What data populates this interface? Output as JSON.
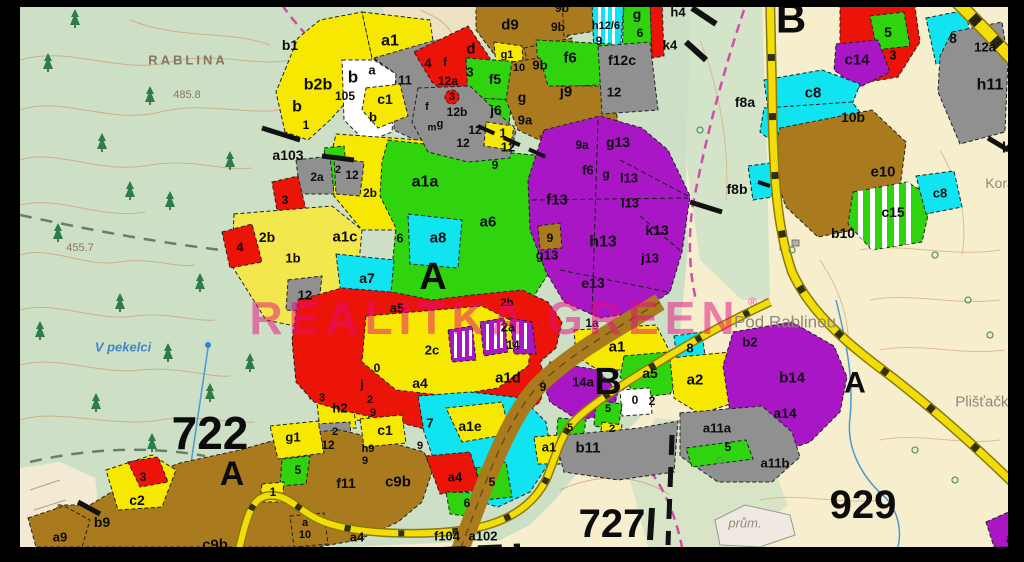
{
  "map": {
    "watermark": {
      "text": "REALITKA GREEN",
      "reg": "®",
      "color": "#e60b84"
    },
    "palette": {
      "yellow": "#f6e800",
      "green": "#2fd40e",
      "cyan": "#10e4f0",
      "red": "#ec1309",
      "purple": "#a816c6",
      "brown": "#a97b1e",
      "gray": "#909090",
      "white": "#ffffff",
      "topo_green": "#cde0c6",
      "topo_cream": "#f6eecd",
      "road_yellow": "#f2dd07",
      "frame": "#000000",
      "water": "#4a9ad4",
      "contour": "#cf9d72"
    },
    "place_names": [
      {
        "t": "RABLINA",
        "x": 188,
        "y": 60,
        "s": 13,
        "c": "#8a7560",
        "sp": 3,
        "w": "bold"
      },
      {
        "t": "V pekelci",
        "x": 123,
        "y": 347,
        "s": 13,
        "c": "#3f86c8",
        "i": true,
        "w": "bold"
      },
      {
        "t": "Pod Rablinou",
        "x": 785,
        "y": 322,
        "s": 17,
        "c": "#8f887a",
        "w": "normal"
      },
      {
        "t": "Plišťačka",
        "x": 986,
        "y": 402,
        "s": 15,
        "c": "#8f887a",
        "w": "normal"
      },
      {
        "t": "Korá",
        "x": 1000,
        "y": 183,
        "s": 14,
        "c": "#8f887a",
        "w": "normal"
      },
      {
        "t": "prům.",
        "x": 745,
        "y": 523,
        "s": 13,
        "c": "#8f887a",
        "i": true,
        "w": "normal"
      }
    ],
    "elevation_points": [
      {
        "t": "485.8",
        "x": 187,
        "y": 95,
        "s": 11,
        "c": "#8a7560"
      },
      {
        "t": "455.7",
        "x": 80,
        "y": 248,
        "s": 11,
        "c": "#8a7560"
      }
    ],
    "zone_labels": [
      [
        "722",
        210,
        433,
        46
      ],
      [
        "A",
        232,
        474,
        34
      ],
      [
        "727",
        612,
        524,
        40
      ],
      [
        "929",
        863,
        505,
        40
      ],
      [
        "A",
        433,
        277,
        38
      ],
      [
        "B",
        791,
        18,
        42
      ],
      [
        "B",
        608,
        382,
        38
      ],
      [
        "A",
        855,
        383,
        30
      ]
    ],
    "parcel_labels": [
      [
        "b1",
        290,
        45,
        14
      ],
      [
        "b2b",
        318,
        85,
        16
      ],
      [
        "b",
        297,
        107,
        16
      ],
      [
        "1",
        306,
        125,
        12
      ],
      [
        "b",
        353,
        77,
        17
      ],
      [
        "105",
        345,
        96,
        12
      ],
      [
        "a",
        372,
        70,
        13
      ],
      [
        "11",
        405,
        80,
        13
      ],
      [
        "c1",
        385,
        99,
        14
      ],
      [
        "b",
        373,
        117,
        13
      ],
      [
        "a1",
        390,
        41,
        16
      ],
      [
        "d9",
        510,
        25,
        15
      ],
      [
        "9b",
        562,
        8,
        12
      ],
      [
        "9b",
        558,
        27,
        12
      ],
      [
        "h12/6",
        606,
        26,
        11
      ],
      [
        "9",
        599,
        41,
        12
      ],
      [
        "g",
        637,
        14,
        14
      ],
      [
        "6",
        640,
        33,
        12
      ],
      [
        "4",
        428,
        63,
        13
      ],
      [
        "d",
        471,
        49,
        15
      ],
      [
        "3",
        470,
        72,
        13
      ],
      [
        "f",
        445,
        62,
        12
      ],
      [
        "12a",
        448,
        81,
        12
      ],
      [
        "3",
        452,
        97,
        11
      ],
      [
        "f5",
        495,
        79,
        14
      ],
      [
        "g1",
        507,
        55,
        11
      ],
      [
        "10",
        519,
        68,
        11
      ],
      [
        "9b",
        540,
        65,
        13
      ],
      [
        "f6",
        570,
        58,
        15
      ],
      [
        "f12c",
        622,
        60,
        14
      ],
      [
        "12",
        614,
        92,
        13
      ],
      [
        "g",
        522,
        97,
        14
      ],
      [
        "j9",
        566,
        92,
        15
      ],
      [
        "j6",
        496,
        110,
        14
      ],
      [
        "9a",
        525,
        120,
        13
      ],
      [
        "1",
        503,
        133,
        13
      ],
      [
        "12",
        508,
        147,
        13
      ],
      [
        "12",
        475,
        130,
        12
      ],
      [
        "12",
        463,
        143,
        12
      ],
      [
        "12b",
        457,
        112,
        12
      ],
      [
        "f",
        427,
        107,
        11
      ],
      [
        "g",
        440,
        124,
        11
      ],
      [
        "m",
        432,
        128,
        10
      ],
      [
        "9a",
        582,
        145,
        12
      ],
      [
        "f6",
        588,
        170,
        13
      ],
      [
        "g",
        606,
        174,
        12
      ],
      [
        "9",
        495,
        165,
        12
      ],
      [
        "g13",
        618,
        142,
        14
      ],
      [
        "l13",
        629,
        178,
        13
      ],
      [
        "l13",
        630,
        203,
        13
      ],
      [
        "f13",
        557,
        200,
        15
      ],
      [
        "h13",
        603,
        242,
        16
      ],
      [
        "k13",
        657,
        230,
        14
      ],
      [
        "j13",
        650,
        258,
        13
      ],
      [
        "e13",
        593,
        283,
        14
      ],
      [
        "g13",
        547,
        255,
        13
      ],
      [
        "9",
        550,
        238,
        12
      ],
      [
        "a103",
        288,
        155,
        14
      ],
      [
        "2a",
        317,
        177,
        12
      ],
      [
        "2",
        338,
        170,
        11
      ],
      [
        "12",
        352,
        175,
        12
      ],
      [
        "3",
        285,
        200,
        12
      ],
      [
        "2b",
        267,
        237,
        14
      ],
      [
        "4",
        240,
        247,
        13
      ],
      [
        "1b",
        293,
        258,
        13
      ],
      [
        "12",
        305,
        295,
        13
      ],
      [
        "a1a",
        425,
        182,
        16
      ],
      [
        "2b",
        370,
        193,
        12
      ],
      [
        "a1c",
        345,
        237,
        15
      ],
      [
        "6",
        400,
        238,
        13
      ],
      [
        "a8",
        438,
        238,
        15
      ],
      [
        "a6",
        488,
        222,
        15
      ],
      [
        "a7",
        367,
        278,
        14
      ],
      [
        "a5",
        397,
        308,
        13
      ],
      [
        "2b",
        507,
        303,
        11
      ],
      [
        "2a",
        508,
        327,
        13
      ],
      [
        "1a",
        592,
        323,
        12
      ],
      [
        "2c",
        432,
        350,
        13
      ],
      [
        "14",
        513,
        345,
        12
      ],
      [
        "a4",
        420,
        383,
        14
      ],
      [
        "a1d",
        508,
        378,
        15
      ],
      [
        "9",
        543,
        387,
        12
      ],
      [
        "h2",
        340,
        408,
        13
      ],
      [
        "3",
        322,
        398,
        11
      ],
      [
        "0",
        377,
        368,
        12
      ],
      [
        "j",
        362,
        385,
        11
      ],
      [
        "2",
        370,
        400,
        11
      ],
      [
        "9",
        373,
        413,
        11
      ],
      [
        "2",
        335,
        432,
        11
      ],
      [
        "c1",
        385,
        430,
        14
      ],
      [
        "h9",
        368,
        449,
        11
      ],
      [
        "9",
        365,
        461,
        11
      ],
      [
        "9",
        420,
        446,
        11
      ],
      [
        "f11",
        346,
        483,
        14
      ],
      [
        "c9b",
        398,
        482,
        15
      ],
      [
        "c9b",
        215,
        545,
        15
      ],
      [
        "b9",
        102,
        522,
        14
      ],
      [
        "a9",
        60,
        537,
        13
      ],
      [
        "c2",
        137,
        500,
        14
      ],
      [
        "3",
        143,
        477,
        12
      ],
      [
        "g1",
        293,
        437,
        13
      ],
      [
        "12",
        328,
        445,
        12
      ],
      [
        "5",
        298,
        470,
        12
      ],
      [
        "1",
        273,
        492,
        12
      ],
      [
        "a",
        305,
        523,
        11
      ],
      [
        "10",
        305,
        535,
        11
      ],
      [
        "a4",
        357,
        537,
        13
      ],
      [
        "f104",
        447,
        536,
        13
      ],
      [
        "a102",
        483,
        536,
        13
      ],
      [
        "7",
        430,
        423,
        13
      ],
      [
        "a1e",
        470,
        426,
        14
      ],
      [
        "a4",
        455,
        477,
        13
      ],
      [
        "5",
        492,
        482,
        12
      ],
      [
        "6",
        467,
        503,
        12
      ],
      [
        "a1",
        549,
        447,
        13
      ],
      [
        "b11",
        588,
        448,
        15
      ],
      [
        "5",
        570,
        428,
        11
      ],
      [
        "2",
        612,
        429,
        11
      ],
      [
        "5",
        608,
        409,
        11
      ],
      [
        "0",
        635,
        400,
        12
      ],
      [
        "2",
        652,
        401,
        12
      ],
      [
        "a1",
        617,
        347,
        15
      ],
      [
        "14a",
        583,
        382,
        13
      ],
      [
        "a5",
        650,
        373,
        14
      ],
      [
        "8",
        690,
        348,
        13
      ],
      [
        "a2",
        695,
        380,
        15
      ],
      [
        "b2",
        750,
        342,
        13
      ],
      [
        "b14",
        792,
        378,
        15
      ],
      [
        "a14",
        785,
        413,
        14
      ],
      [
        "a11a",
        717,
        428,
        13
      ],
      [
        "5",
        728,
        447,
        12
      ],
      [
        "a11b",
        775,
        463,
        13
      ],
      [
        "h4",
        678,
        12,
        13
      ],
      [
        "k4",
        670,
        45,
        13
      ],
      [
        "5",
        888,
        32,
        14
      ],
      [
        "3",
        893,
        55,
        13
      ],
      [
        "c14",
        857,
        60,
        15
      ],
      [
        "8",
        953,
        38,
        14
      ],
      [
        "12a",
        985,
        47,
        13
      ],
      [
        "h11",
        990,
        85,
        16
      ],
      [
        "c8",
        813,
        93,
        15
      ],
      [
        "10b",
        853,
        117,
        14
      ],
      [
        "f8a",
        745,
        102,
        14
      ],
      [
        "k",
        1006,
        148,
        15
      ],
      [
        "e10",
        883,
        172,
        15
      ],
      [
        "c15",
        893,
        212,
        14
      ],
      [
        "c8",
        940,
        193,
        13
      ],
      [
        "b10",
        843,
        233,
        14
      ],
      [
        "f8b",
        737,
        189,
        14
      ],
      [
        "a",
        1010,
        538,
        14
      ]
    ]
  }
}
